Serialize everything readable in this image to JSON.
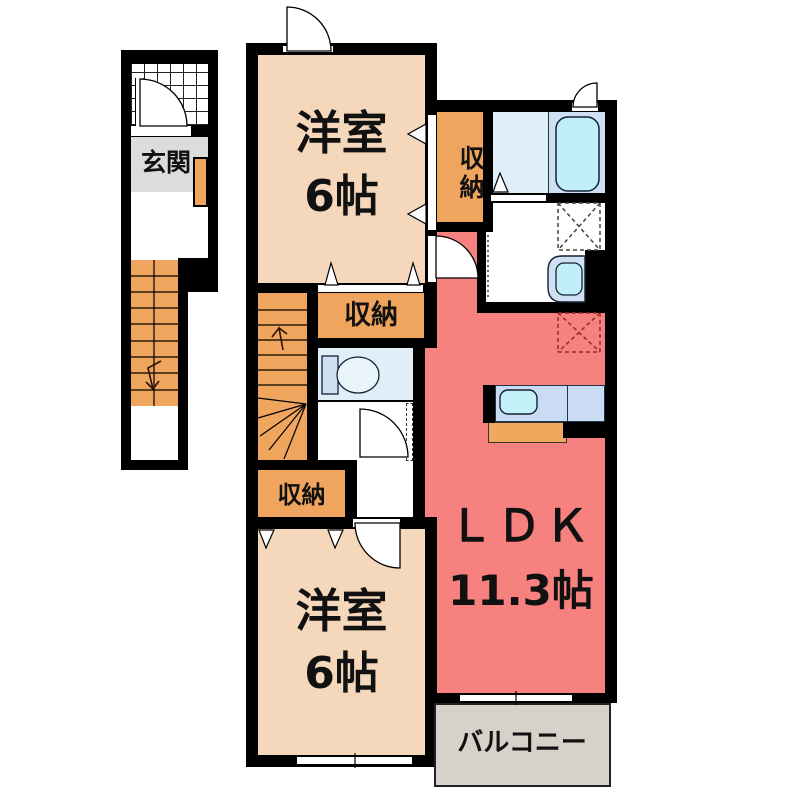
{
  "floorplan": {
    "type": "japanese-apartment-floor-plan",
    "rooms": {
      "genkan": {
        "label": "玄関"
      },
      "western_room_top": {
        "name": "洋室",
        "size": "6帖"
      },
      "western_room_bottom": {
        "name": "洋室",
        "size": "6帖"
      },
      "ldk": {
        "name": "ＬＤＫ",
        "size": "11.3帖"
      },
      "closet_right": {
        "label": "収納"
      },
      "closet_middle": {
        "label": "収納"
      },
      "closet_lower": {
        "label": "収納"
      },
      "balcony": {
        "label": "バルコニー"
      }
    },
    "fixtures": [
      "entrance-door",
      "entrance-staircase",
      "internal-staircase",
      "bathtub",
      "bathroom",
      "washroom-sink",
      "washing-machine-space",
      "toilet",
      "kitchen-counter",
      "kitchen-sink",
      "refrigerator-space",
      "sliding-closet-doors",
      "casement-windows",
      "balcony-window"
    ],
    "colors": {
      "wall": "#000000",
      "room_peach": "#f5d8bb",
      "closet_orange": "#efa55d",
      "ldk_red": "#f6817f",
      "floor_blue": "#e0eef8",
      "fixture_blue": "#c2eef8",
      "fixture_light": "#cfe0f2",
      "counter_blue": "#cadcf4",
      "genkan_gray": "#dcdcdc",
      "balcony_gray": "#d6d2c9"
    }
  }
}
